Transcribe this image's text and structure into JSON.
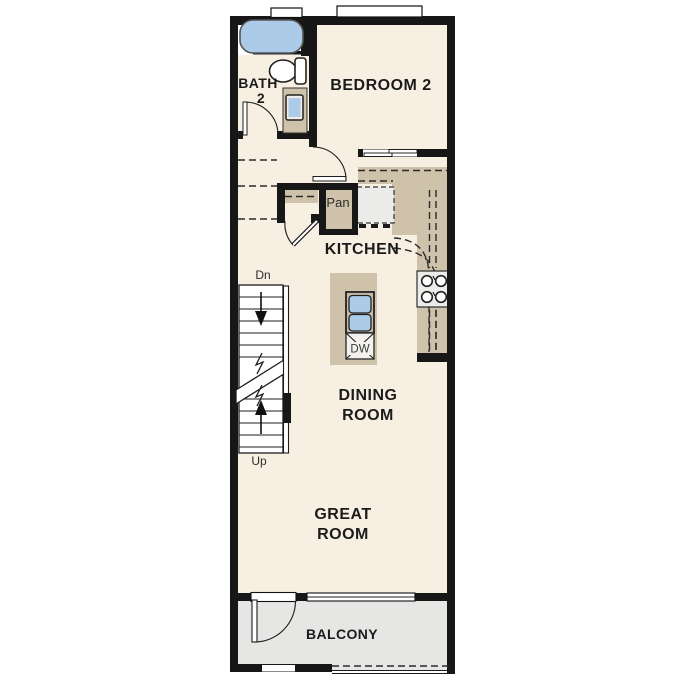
{
  "plan": {
    "rooms": {
      "bedroom2": "BEDROOM 2",
      "bath_line1": "BATH",
      "bath_line2": "2",
      "kitchen": "KITCHEN",
      "dining_line1": "DINING",
      "dining_line2": "ROOM",
      "great_line1": "GREAT",
      "great_line2": "ROOM",
      "balcony": "BALCONY"
    },
    "labels": {
      "pantry": "Pan",
      "dishwasher": "DW",
      "stair_down": "Dn",
      "stair_up": "Up"
    },
    "colors": {
      "wall": "#171717",
      "floor": "#f7f0e2",
      "counter": "#cec2aa",
      "fixture_blue": "#abcbe9",
      "balcony_floor": "#e6e6e4",
      "appliance_gray": "#ebebe9"
    }
  }
}
